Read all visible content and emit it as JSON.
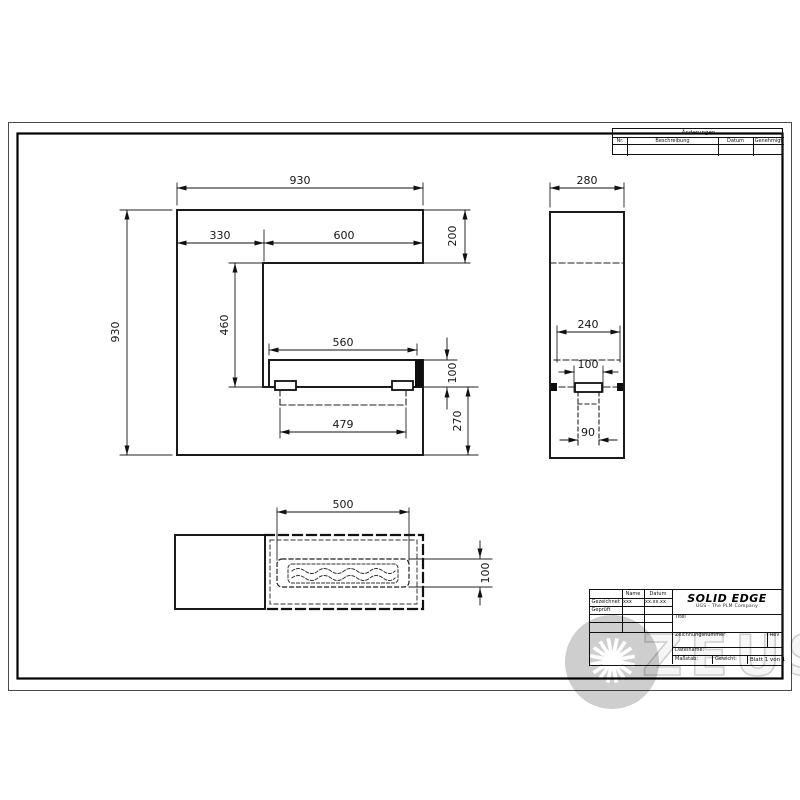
{
  "drawing": {
    "brand": {
      "name": "SOLID EDGE",
      "subtitle": "UGS - The PLM Company"
    },
    "revision_table": {
      "title": "Änderungen",
      "col_nr": "Nr.",
      "col_desc": "Beschreibung",
      "col_date": "Datum",
      "col_approved": "Genehmigt"
    },
    "title_block": {
      "col_name": "Name",
      "col_date": "Datum",
      "row_drawn_label": "Gezeichnet",
      "row_drawn_name": "xxx",
      "row_drawn_date": "xx.xx.xx",
      "row_checked_label": "Geprüft",
      "title_label": "Titel",
      "number_label": "Zeichnungsnummer",
      "rev_label": "Rev",
      "filename_label": "Dateiname:",
      "scale_label": "Maßstab:",
      "weight_label": "Gewicht:",
      "sheet_label": "Blatt 1 von 1"
    },
    "views": {
      "front": {
        "width_top": "930",
        "offset_left": "330",
        "opening": "600",
        "band_height": "200",
        "height": "930",
        "drop": "460",
        "shelf_width": "560",
        "shelf_height": "100",
        "base_height": "270",
        "hidden_width": "479"
      },
      "side": {
        "depth": "280",
        "inner_width": "240",
        "slot_width": "100",
        "foot_width": "90"
      },
      "bottom": {
        "tray_length": "500",
        "tray_depth": "100"
      }
    },
    "watermark": {
      "text": "ZEUS"
    }
  }
}
